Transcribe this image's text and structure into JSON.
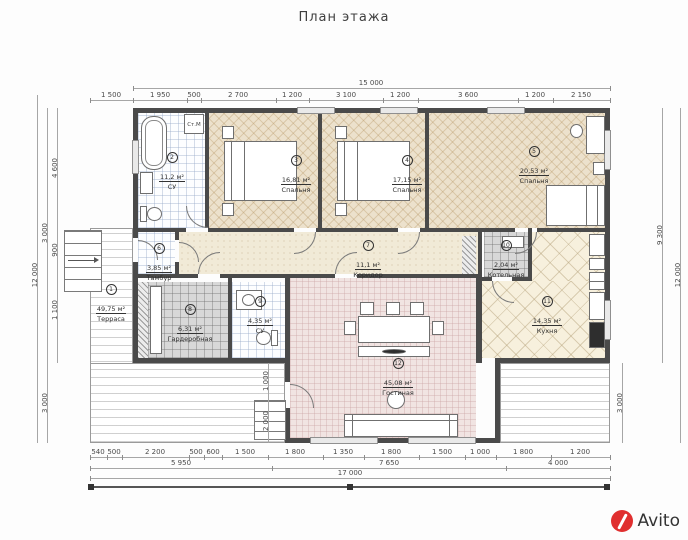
{
  "title": "План этажа",
  "watermark": {
    "brand": "Avito"
  },
  "fixture_labels": {
    "washer": "Ст.М"
  },
  "rooms": {
    "terrace": {
      "num": "1",
      "area": "49,75 м²",
      "name": "Терраса"
    },
    "bath1": {
      "num": "2",
      "area": "11,2 м²",
      "name": "СУ"
    },
    "bedroom1": {
      "num": "3",
      "area": "16,81 м²",
      "name": "Спальня"
    },
    "bedroom2": {
      "num": "4",
      "area": "17,15 м²",
      "name": "Спальня"
    },
    "bedroom3": {
      "num": "5",
      "area": "20,53 м²",
      "name": "Спальня"
    },
    "tambur": {
      "num": "6",
      "area": "3,85 м²",
      "name": "Тамбур"
    },
    "corridor": {
      "num": "7",
      "area": "11,1 м²",
      "name": "Коридор"
    },
    "wardrobe": {
      "num": "8",
      "area": "6,31 м²",
      "name": "Гардеробная"
    },
    "bath2": {
      "num": "9",
      "area": "4,35 м²",
      "name": "СУ"
    },
    "boiler": {
      "num": "10",
      "area": "2,04 м²",
      "name": "Котельная"
    },
    "kitchen": {
      "num": "11",
      "area": "14,35 м²",
      "name": "Кухня"
    },
    "living": {
      "num": "12",
      "area": "45,08 м²",
      "name": "Гостиная"
    }
  },
  "dimensions": {
    "top_total": "15 000",
    "top_offset": "1 500",
    "top_chain": [
      "1 950",
      "500",
      "2 700",
      "1 200",
      "3 100",
      "1 200",
      "3 600",
      "1 200",
      "2 150"
    ],
    "left": {
      "seg1": "4 600",
      "seg2": "900",
      "seg3": "1 100",
      "span": "3 000",
      "total": "12 000",
      "terrace": "3 000"
    },
    "right": {
      "house": "9 300",
      "total": "12 000",
      "terrace": "3 000"
    },
    "inner_chain": [
      "1 000",
      "2 000"
    ],
    "bottom_chain": [
      "540",
      "500",
      "2 200",
      "500",
      "600",
      "1 500",
      "1 800",
      "1 350",
      "1 800",
      "1 500",
      "1 000",
      "1 800",
      "1 200"
    ],
    "bottom_groups": [
      "5 950",
      "7 650",
      "4 000"
    ],
    "bottom_total": "17 000"
  }
}
